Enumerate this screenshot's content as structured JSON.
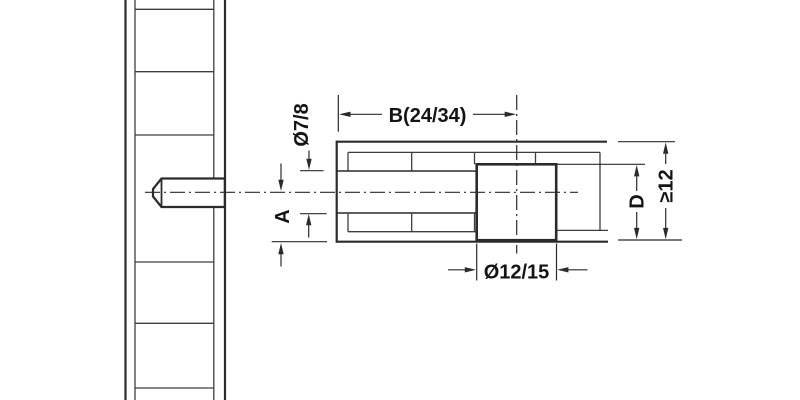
{
  "diagram": {
    "title": "connector-bolt-technical-drawing",
    "labels": {
      "dim_b": "B(24/34)",
      "dim_shaft_dia": "Ø7/8",
      "dim_a": "A",
      "dim_hole_dia": "Ø12/15",
      "dim_d": "D",
      "dim_min_thickness": "≥12"
    },
    "colors": {
      "line": "#2b2b2b",
      "thin_line": "#3e3e3e",
      "background": "#ffffff",
      "text": "#141414"
    }
  }
}
